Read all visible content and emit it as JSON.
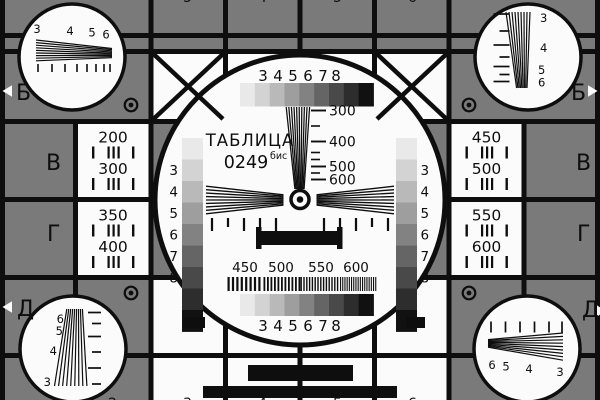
{
  "card": {
    "title": {
      "line1": "ТАБЛИЦА",
      "number": "0249",
      "suffix": "бис"
    },
    "colors": {
      "bg": "#7a7a7a",
      "ink": "#0e0e0e",
      "paper": "#fbfbfb",
      "grayscale": [
        "#e9e9e9",
        "#d3d3d3",
        "#b9b9b9",
        "#9e9e9e",
        "#828282",
        "#656565",
        "#494949",
        "#2d2d2d",
        "#111111"
      ]
    },
    "step_labels": [
      "3",
      "4",
      "5",
      "6",
      "7",
      "8"
    ],
    "wedge_labels": [
      "300",
      "400",
      "500",
      "600"
    ],
    "freq_labels": [
      "450",
      "500",
      "550",
      "600"
    ],
    "left_cells": [
      [
        "200",
        "300"
      ],
      [
        "350",
        "400"
      ]
    ],
    "right_cells": [
      [
        "450",
        "500"
      ],
      [
        "550",
        "600"
      ]
    ],
    "row_letters_left": [
      "Б",
      "В",
      "Г",
      "Д"
    ],
    "row_letters_right": [
      "Б",
      "В",
      "Г",
      "Д"
    ],
    "corner_fan_labels": {
      "top_left": [
        "3",
        "4",
        "5",
        "6"
      ],
      "top_right": [
        "3",
        "4",
        "5",
        "6"
      ],
      "bottom_left": [
        "6",
        "5",
        "4",
        "3"
      ],
      "bottom_right": [
        "6",
        "5",
        "4",
        "3"
      ]
    },
    "column_digits_top": [
      "3",
      "4",
      "5",
      "6"
    ],
    "column_digits_bottom": [
      "2",
      "3",
      "4",
      "5",
      "6"
    ]
  }
}
